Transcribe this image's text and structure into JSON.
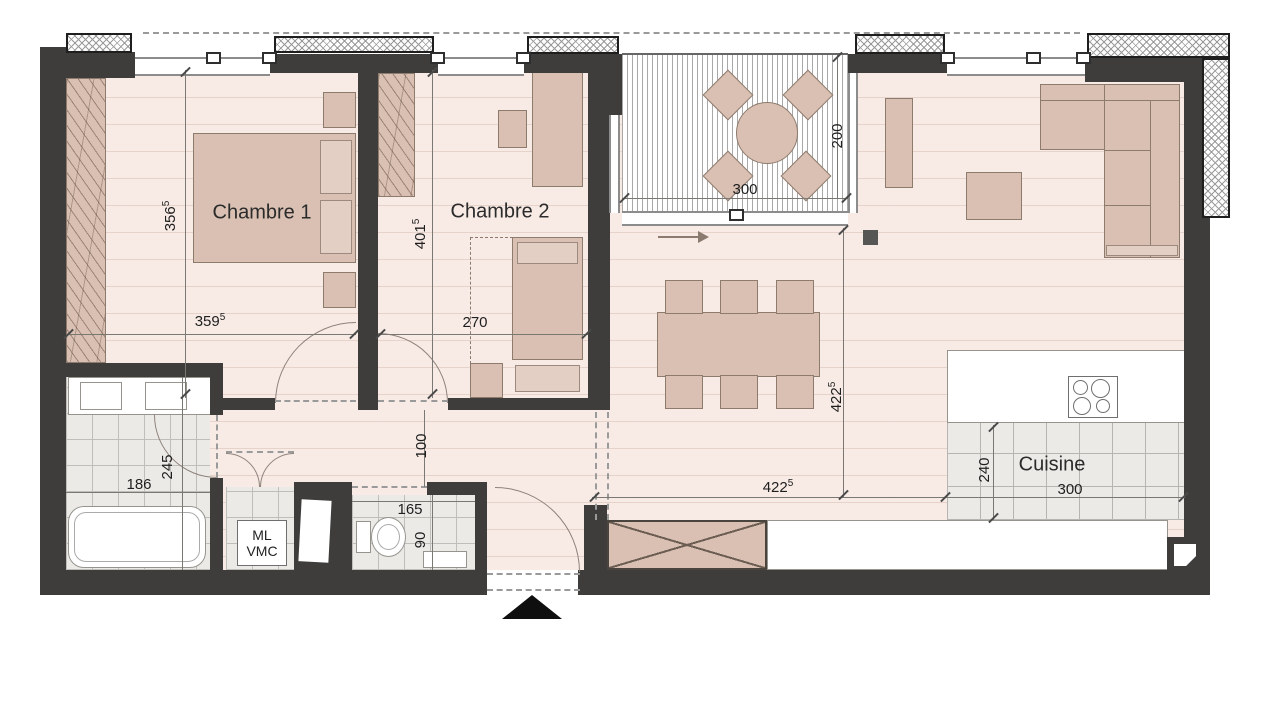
{
  "plan_type": "apartment-floor-plan",
  "rooms": {
    "chambre1": {
      "label": "Chambre 1",
      "width": "359",
      "width_sup": "5",
      "height": "356",
      "height_sup": "5"
    },
    "chambre2": {
      "label": "Chambre 2",
      "width": "270",
      "width_sup": "",
      "height": "401",
      "height_sup": "5"
    },
    "terrasse": {
      "width": "300",
      "width_sup": "",
      "height": "200",
      "height_sup": ""
    },
    "sejour": {
      "width": "422",
      "width_sup": "5",
      "height": "422",
      "height_sup": "5"
    },
    "cuisine": {
      "label": "Cuisine",
      "width": "300",
      "width_sup": "",
      "height": "240",
      "height_sup": ""
    },
    "salle_de_bains": {
      "width": "186",
      "width_sup": "",
      "height": "245",
      "height_sup": ""
    },
    "wc": {
      "width": "165",
      "width_sup": "",
      "height": "90",
      "height_sup": ""
    },
    "degagement": {
      "width": "100",
      "width_sup": ""
    },
    "placard_technique": {
      "label_line1": "ML",
      "label_line2": "VMC"
    }
  },
  "colors": {
    "wall": "#3e3d3b",
    "floor": "#f8ebe5",
    "furniture": "#d9c0b2",
    "tile": "#ebeae7",
    "insulation_hatch": "#9a9a9a"
  }
}
